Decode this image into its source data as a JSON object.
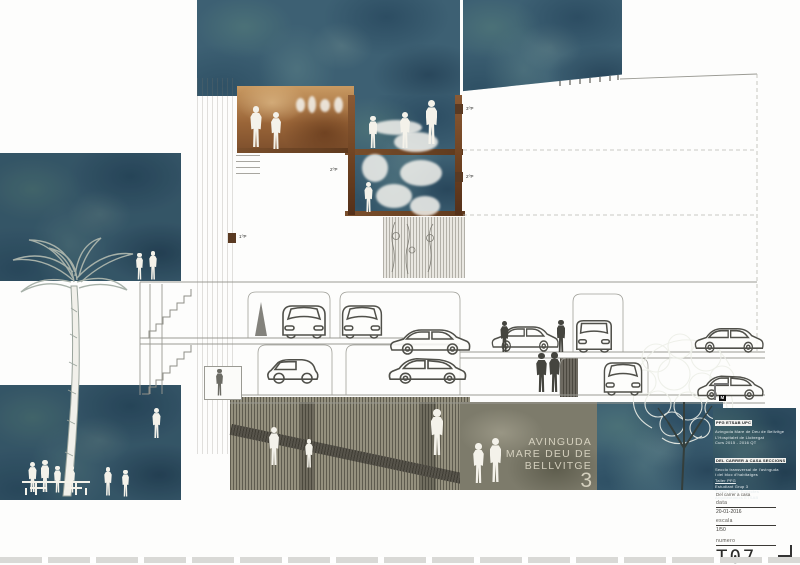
{
  "drawing": {
    "street_label": {
      "line1": "AVINGUDA",
      "line2": "MARE DEU DE",
      "line3": "BELLVITGE",
      "number": "3"
    },
    "level_markers": [
      "3ºP",
      "2ºP",
      "2ºP",
      "1ºP"
    ],
    "colors": {
      "teal": "#3d6073",
      "terracotta": "#9a6538",
      "concrete": "#94907e",
      "olive": "#7d7b6b"
    }
  },
  "title_block": {
    "logo": {
      "m": "M",
      "arq": "ARQ",
      "etsab": "ETSAB"
    },
    "fine_print": {
      "tab": "PFG  ETSAB  UPC",
      "l1": "Avinguda Mare de Deu de Bellvitge",
      "l2": "L'Hospitalet de Llobregat",
      "l3": "Curs 2015 - 2016  QT",
      "header": "DEL CARRER A CASA  SECCIONS",
      "l4": "Seccio transversal de l'avinguda",
      "l5": "i del bloc d'habitatges",
      "l6": "Taller PFG",
      "l7": "Estudiant  Grup 3",
      "l8": "Tutors  Dept. Projectes",
      "l9": "Arquitectonics  ETSAB"
    },
    "project_title": "Del carrer a casa",
    "fields": {
      "date_label": "data",
      "date_value": "20-01-2016",
      "scale_label": "escala",
      "scale_value": "1/50",
      "number_label": "numero",
      "number_value": "T07"
    }
  }
}
